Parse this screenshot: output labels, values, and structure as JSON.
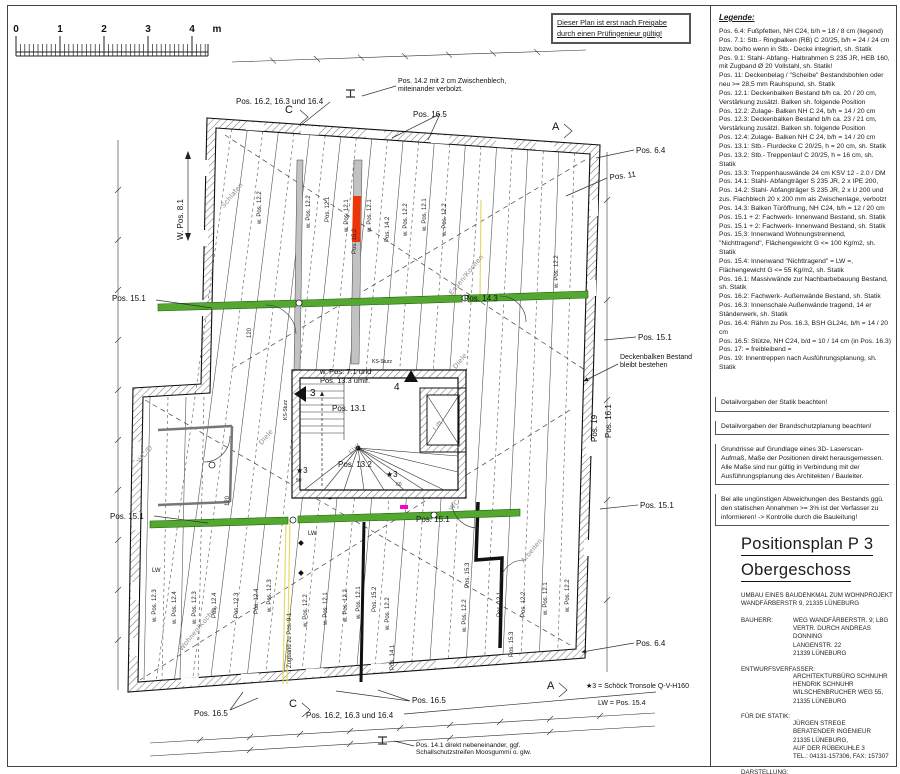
{
  "sheet": {
    "approval_note": "Dieser Plan ist erst nach Freigabe durch einen Prüfingenieur gültig!",
    "scalebar": {
      "labels": [
        "0",
        "1",
        "2",
        "3",
        "4",
        "m"
      ]
    }
  },
  "legend": {
    "heading": "Legende:",
    "entries": [
      "Pos. 6.4: Fußpfetten, NH C24, b/h = 18 / 8 cm (liegend)",
      "Pos. 7.1: Stb.- Ringbalken (RB) C 20/25, b/h = 24 / 24 cm bzw. bo/ho wenn in Stb.- Decke integriert, sh. Statik",
      "Pos. 9.1: Stahl- Abfang- Halbrahmen S 235 JR, HEB 160, mit Zugband Ø 20 Vollstahl, sh. Statik!",
      "Pos. 11: Deckenbelag / \"Scheibe\" Bestandsbohlen oder neu >= 28,5 mm Rauhspund, sh. Statik",
      "Pos. 12.1: Deckenbalken Bestand b/h ca. 20 / 20 cm, Verstärkung zusätzl. Balken sh. folgende Position",
      "Pos. 12.2: Zulage- Balken NH C 24, b/h = 14 / 20 cm",
      "Pos. 12.3: Deckenbalken Bestand b/h ca. 23 / 21 cm, Verstärkung zusätzl. Balken sh. folgende Position",
      "Pos. 12.4: Zulage- Balken NH C 24, b/h = 14 / 20 cm",
      "Pos. 13.1: Stb.- Flurdecke C 20/25, h = 20 cm, sh. Statik",
      "Pos. 13.2: Stb.- Treppenlauf C 20/25, h = 16 cm, sh. Statik",
      "Pos. 13.3: Treppenhauswände 24 cm KSV 12 - 2.0 / DM",
      "Pos. 14.1: Stahl- Abfangträger S 235 JR, 2 x IPE 200,",
      "Pos. 14.2: Stahl- Abfangträger S 235 JR, 2 x U 200 und zus. Flachblech 20 x 200 mm als Zwischenlage, verbolzt",
      "Pos. 14.3: Balken Türöffnung, NH C24, b/h = 12 / 20 cm",
      "Pos. 15.1 + 2: Fachwerk- Innenwand Bestand, sh. Statik",
      "Pos. 15.1 + 2: Fachwerk- Innenwand Bestand, sh. Statik",
      "Pos. 15.3: Innenwand Wohnungstrennend, \"Nichttragend\", Flächengewicht G <= 100 Kg/m2, sh. Statik",
      "Pos. 15.4: Innenwand \"Nichttragend\" = LW =, Flächengewicht G <= 55 Kg/m2, sh. Statik",
      "Pos. 16.1: Massivwände zur Nachbarbebauung Bestand, sh. Statik",
      "Pos. 16.2: Fachwerk- Außenwände Bestand, sh. Statik",
      "Pos. 16.3: Innenschale Außenwände tragend, 14 er Ständerwerk, sh. Statik",
      "Pos. 16.4: Rähm zu Pos. 16.3, BSH GL24c, b/h = 14 / 20 cm",
      "Pos. 16.5: Stütze, NH C24, b/d = 10 / 14 cm (in Pos. 16.3)",
      "Pos. 17: = freibleibend =",
      "Pos. 19: Innentreppen nach Ausführungsplanung, sh. Statik"
    ]
  },
  "notes": [
    "Detailvorgaben der Statik beachten!",
    "Detailvorgaben der Brandschutzplanung beachten!",
    "Grundrisse auf Grundlage eines 3D- Laserscan- Aufmaß, Maße der Positionen direkt herausgemessen.\nAlle Maße sind nur gültig in Verbindung mit der Ausführungsplanung des Architekten / Bauleiter.",
    "Bei alle ungünstigen Abweichungen des Bestands ggü. den statischen Annahmen >= 3% ist der Verfasser zu informieren! -> Kontrolle durch die Bauleitung!"
  ],
  "title_block": {
    "title_line1": "Positionsplan P 3",
    "title_line2": "Obergeschoss",
    "project_desc": "UMBAU EINES BAUDENKMAL ZUM WOHNPROJEKT\nWANDFÄRBERSTR 9, 21335 LÜNEBURG",
    "bauherr_label": "BAUHERR:",
    "bauherr": "WEG WANDFÄRBERSTR. 9; LBG\nVERTR. DURCH ANDREAS DONNING\nLANGENSTR. 22\n21339 LÜNEBURG",
    "entwurf_label": "ENTWURFSVERFASSER:",
    "entwurf": "ARCHITEKTURBÜRO SCHNUHR\nHENDRIK SCHNUHR\nWILSCHENBRUCHER WEG 55,\n21335 LÜNEBURG",
    "statik_label": "FÜR DIE STATIK:",
    "statik": "JÜRGEN STREGE\nBERATENDER INGENIEUR\n21335 LÜNEBURG,\nAUF DER RÜBEKUHLE 3\nTEL.: 04131-157306, FAX: 157307",
    "darstellung_label": "DARSTELLUNG:",
    "darstellung": "OBERGESCHOSS M.: 1 : 50",
    "projekt": "PROJEKT: 202211",
    "datum": "LÜNEBURG, DEN 10.01.2023"
  },
  "colors": {
    "beam_green": "#55a82f",
    "wall_red": "#ee3407",
    "zugband_yellow": "#e6d96a",
    "marker_magenta": "#ff00cc"
  },
  "plan": {
    "labels": [
      {
        "t": "Pos. 14.2 mit 2 cm Zwischenblech,\nmiteinander verbolzt.",
        "x": 398,
        "y": 78,
        "s": 7,
        "n": "label-pos-14-2-note"
      },
      {
        "t": "Pos. 16.2, 16.3 und 16.4",
        "x": 236,
        "y": 97,
        "n": "label-pos-16-group-top"
      },
      {
        "t": "Pos. 16.5",
        "x": 413,
        "y": 110
      },
      {
        "t": "C",
        "x": 285,
        "y": 104,
        "s": 11,
        "n": "section-marker-c-top"
      },
      {
        "t": "A",
        "x": 552,
        "y": 121,
        "s": 11,
        "n": "section-marker-a-top"
      },
      {
        "t": "Pos. 6.4",
        "x": 636,
        "y": 146
      },
      {
        "t": "Pos. 11",
        "x": 609,
        "y": 173,
        "r": -7
      },
      {
        "t": "Pos. 15.1",
        "x": 638,
        "y": 333
      },
      {
        "t": "Deckenbalken Bestand\nbleibt bestehen",
        "x": 620,
        "y": 354,
        "s": 7,
        "n": "label-deckenbalken-note"
      },
      {
        "t": "Pos. 16.1",
        "x": 604,
        "y": 438,
        "r": -90
      },
      {
        "t": "Pos. 19",
        "x": 590,
        "y": 442,
        "r": -90
      },
      {
        "t": "Pos. 15.1",
        "x": 640,
        "y": 501
      },
      {
        "t": "Pos. 6.4",
        "x": 636,
        "y": 639
      },
      {
        "t": "W. Pos. 8.1",
        "x": 176,
        "y": 240,
        "r": -90
      },
      {
        "t": "Pos. 15.1",
        "x": 112,
        "y": 294
      },
      {
        "t": "Pos. 15.1",
        "x": 110,
        "y": 512
      },
      {
        "t": "Pos. 16.5",
        "x": 194,
        "y": 709
      },
      {
        "t": "C",
        "x": 289,
        "y": 698,
        "s": 11,
        "n": "section-marker-c-bottom"
      },
      {
        "t": "Pos. 16.2, 16.3 und 16.4",
        "x": 306,
        "y": 711,
        "n": "label-pos-16-group-bottom"
      },
      {
        "t": "Pos. 16.5",
        "x": 412,
        "y": 696
      },
      {
        "t": "A",
        "x": 547,
        "y": 680,
        "s": 11,
        "n": "section-marker-a-bottom"
      },
      {
        "t": "★3 = Schöck Tronsole Q-V-H160",
        "x": 586,
        "y": 683,
        "s": 7,
        "n": "label-schoeck-note"
      },
      {
        "t": "LW = Pos. 15.4",
        "x": 598,
        "y": 700,
        "s": 7,
        "n": "label-lw-note"
      },
      {
        "t": "Pos. 14.1 direkt nebeneinander, ggf.\nSchallschutzstreifen Moosgummi o. glw.",
        "x": 416,
        "y": 742,
        "s": 6.5,
        "n": "label-pos-14-1-note"
      },
      {
        "t": "w. Pos. 7.1 und\nPos. 13.3 umlf.",
        "x": 320,
        "y": 368,
        "s": 7.5
      },
      {
        "t": "Pos. 13.1",
        "x": 332,
        "y": 404
      },
      {
        "t": "Pos. 13.2",
        "x": 338,
        "y": 460
      },
      {
        "t": "3",
        "x": 310,
        "y": 388,
        "s": 10,
        "n": "triangle-marker-3"
      },
      {
        "t": "4",
        "x": 394,
        "y": 382,
        "s": 10,
        "n": "triangle-marker-4"
      },
      {
        "t": "KS-Sturz",
        "x": 372,
        "y": 360,
        "s": 5
      },
      {
        "t": "KS-Sturz",
        "x": 284,
        "y": 420,
        "r": -90,
        "s": 5
      },
      {
        "t": "50",
        "x": 296,
        "y": 479,
        "s": 5,
        "c": "dim"
      },
      {
        "t": "60",
        "x": 396,
        "y": 483,
        "s": 5,
        "c": "dim"
      },
      {
        "t": "★3",
        "x": 296,
        "y": 466,
        "s": 8
      },
      {
        "t": "★3",
        "x": 386,
        "y": 470,
        "s": 8
      },
      {
        "t": "Pos. 15.1",
        "x": 416,
        "y": 515
      },
      {
        "t": "Pos. 14.3",
        "x": 464,
        "y": 294
      },
      {
        "t": "120",
        "x": 247,
        "y": 338,
        "r": -90,
        "s": 6,
        "c": "dim"
      },
      {
        "t": "120",
        "x": 225,
        "y": 506,
        "r": -90,
        "s": 6,
        "c": "dim"
      },
      {
        "t": "LW",
        "x": 308,
        "y": 531,
        "s": 6
      },
      {
        "t": "LW",
        "x": 152,
        "y": 568,
        "s": 6
      },
      {
        "t": "Schlafen",
        "x": 220,
        "y": 205,
        "c": "room",
        "r": -50
      },
      {
        "t": "Essen/Kochen",
        "x": 448,
        "y": 292,
        "c": "room",
        "r": -50
      },
      {
        "t": "Diele",
        "x": 452,
        "y": 366,
        "c": "room",
        "r": -50
      },
      {
        "t": "Flur",
        "x": 348,
        "y": 452,
        "c": "room",
        "r": -50
      },
      {
        "t": "Lift",
        "x": 432,
        "y": 428,
        "c": "room",
        "r": -50
      },
      {
        "t": "WC",
        "x": 448,
        "y": 508,
        "c": "room",
        "r": -50
      },
      {
        "t": "WC/D",
        "x": 136,
        "y": 460,
        "c": "room",
        "r": -50
      },
      {
        "t": "Diele",
        "x": 258,
        "y": 442,
        "c": "room",
        "r": -50
      },
      {
        "t": "Wohnen/Kochen",
        "x": 178,
        "y": 648,
        "c": "room",
        "r": -50
      },
      {
        "t": "Arbeiten",
        "x": 520,
        "y": 560,
        "c": "room",
        "r": -50
      },
      {
        "t": "w. Pos. 12.2",
        "x": 306,
        "y": 228,
        "c": "joist",
        "r": -90
      },
      {
        "t": "Pos. 12.1",
        "x": 325,
        "y": 222,
        "c": "joist",
        "r": -90
      },
      {
        "t": "w. Pos. 12.1",
        "x": 344,
        "y": 232,
        "c": "joist",
        "r": -90
      },
      {
        "t": "Pos. 15.2",
        "x": 352,
        "y": 254,
        "c": "joist",
        "r": -90
      },
      {
        "t": "w. Pos. 12.1",
        "x": 367,
        "y": 232,
        "c": "joist",
        "r": -90
      },
      {
        "t": "Pos. 14.2",
        "x": 385,
        "y": 242,
        "c": "joist",
        "r": -90
      },
      {
        "t": "w. Pos. 12.2",
        "x": 403,
        "y": 236,
        "c": "joist",
        "r": -90
      },
      {
        "t": "w. Pos. 12.1",
        "x": 422,
        "y": 231,
        "c": "joist",
        "r": -90
      },
      {
        "t": "w. Pos. 12.2",
        "x": 442,
        "y": 236,
        "c": "joist",
        "r": -90
      },
      {
        "t": "w. Pos. 12.2",
        "x": 554,
        "y": 288,
        "c": "joist",
        "r": -90
      },
      {
        "t": "w. Pos. 12.2",
        "x": 257,
        "y": 224,
        "c": "joist",
        "r": -90
      },
      {
        "t": "w. Pos. 12.3",
        "x": 152,
        "y": 622,
        "c": "joist",
        "r": -90
      },
      {
        "t": "w. Pos. 12.4",
        "x": 172,
        "y": 624,
        "c": "joist",
        "r": -90
      },
      {
        "t": "w. Pos. 12.3",
        "x": 192,
        "y": 624,
        "c": "joist",
        "r": -90
      },
      {
        "t": "Pos. 12.4",
        "x": 212,
        "y": 618,
        "c": "joist",
        "r": -90
      },
      {
        "t": "Pos. 12.3",
        "x": 234,
        "y": 618,
        "c": "joist",
        "r": -90
      },
      {
        "t": "Pos. 12.4",
        "x": 254,
        "y": 614,
        "c": "joist",
        "r": -90
      },
      {
        "t": "w. Pos. 12.3",
        "x": 267,
        "y": 612,
        "c": "joist",
        "r": -90
      },
      {
        "t": "Zugband zu Pos. 9.1",
        "x": 287,
        "y": 668,
        "c": "joist",
        "r": -90
      },
      {
        "t": "w. Pos. 12.2",
        "x": 303,
        "y": 627,
        "c": "joist",
        "r": -90
      },
      {
        "t": "w. Pos. 12.1",
        "x": 323,
        "y": 625,
        "c": "joist",
        "r": -90
      },
      {
        "t": "w. Pos. 12.2",
        "x": 343,
        "y": 622,
        "c": "joist",
        "r": -90
      },
      {
        "t": "w. Pos. 12.1",
        "x": 356,
        "y": 619,
        "c": "joist",
        "r": -90
      },
      {
        "t": "Pos. 15.2",
        "x": 372,
        "y": 612,
        "c": "joist",
        "r": -90
      },
      {
        "t": "w. Pos. 12.2",
        "x": 385,
        "y": 630,
        "c": "joist",
        "r": -90
      },
      {
        "t": "Pos. 14.1",
        "x": 390,
        "y": 670,
        "c": "joist",
        "r": -90
      },
      {
        "t": "Pos. 15.3",
        "x": 465,
        "y": 588,
        "c": "joist",
        "r": -90
      },
      {
        "t": "w. Pos. 12.2",
        "x": 462,
        "y": 632,
        "c": "joist",
        "r": -90
      },
      {
        "t": "Pos. 12.1",
        "x": 497,
        "y": 617,
        "c": "joist",
        "r": -90
      },
      {
        "t": "Pos. 12.2",
        "x": 521,
        "y": 617,
        "c": "joist",
        "r": -90
      },
      {
        "t": "w. Pos. 12.1",
        "x": 543,
        "y": 615,
        "c": "joist",
        "r": -90
      },
      {
        "t": "w. Pos. 12.2",
        "x": 565,
        "y": 612,
        "c": "joist",
        "r": -90
      },
      {
        "t": "Pos. 15.3",
        "x": 509,
        "y": 657,
        "c": "joist",
        "r": -90
      }
    ]
  }
}
